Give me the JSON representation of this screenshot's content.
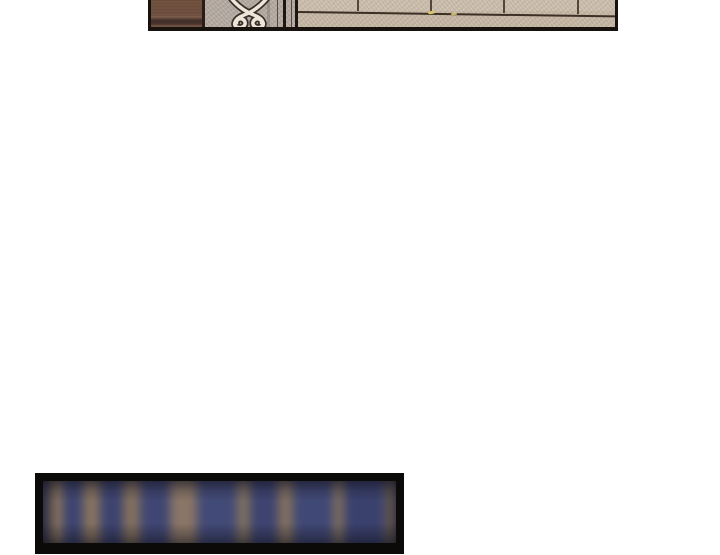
{
  "page": {
    "background_color": "#ffffff",
    "description": "vertical-scroll comic reader page with two image panels and no text"
  },
  "top_panel": {
    "description": "cropped comic panel: wooden post, stone gate pillar with iron scroll ornament, iron bars, stone wall in slight perspective",
    "border_color": "#17120e",
    "wood_post_color": "#6f5041",
    "wood_band_color": "#47332b",
    "pillar_color": "#b4aaa2",
    "ornament": {
      "fill": "#ece5d8",
      "outline": "#39302a"
    },
    "gate_bars": [
      {
        "x": 126,
        "type": "thin"
      },
      {
        "x": 132,
        "type": "thick"
      },
      {
        "x": 140,
        "type": "thin"
      },
      {
        "x": 144,
        "type": "thick"
      }
    ],
    "wall_color": "#c7b9a7",
    "mortar_color": "#3b2f26",
    "joints": [
      {
        "x": 206,
        "h": 11
      },
      {
        "x": 279,
        "h": 12
      },
      {
        "x": 352,
        "h": 13
      },
      {
        "x": 426,
        "h": 14
      }
    ],
    "specks": [
      {
        "x": 277,
        "y": 11,
        "w": 7,
        "h": 3,
        "color": "#d9c46a",
        "rot": -8
      },
      {
        "x": 300,
        "y": 13,
        "w": 6,
        "h": 2,
        "color": "#cdb964",
        "rot": -5
      }
    ]
  },
  "bottom_panel": {
    "description": "blurred photo-like panel of brown fence posts against dark blue dusk background in a black frame",
    "frame_color": "#0b0a09",
    "base_color": "#3e4572",
    "blur_px": 5,
    "segments": [
      {
        "w": 5,
        "c": "#39406b"
      },
      {
        "w": 15,
        "c": "#84705e"
      },
      {
        "w": 20,
        "c": "#3d4470"
      },
      {
        "w": 17,
        "c": "#87735f"
      },
      {
        "w": 23,
        "c": "#3c436f"
      },
      {
        "w": 17,
        "c": "#83705e"
      },
      {
        "w": 30,
        "c": "#3f4673"
      },
      {
        "w": 27,
        "c": "#8a7666"
      },
      {
        "w": 40,
        "c": "#424a77"
      },
      {
        "w": 13,
        "c": "#80705f"
      },
      {
        "w": 28,
        "c": "#3d4470"
      },
      {
        "w": 15,
        "c": "#83705e"
      },
      {
        "w": 40,
        "c": "#404875"
      },
      {
        "w": 11,
        "c": "#7f6e5d"
      },
      {
        "w": 42,
        "c": "#3a416d"
      },
      {
        "w": 10,
        "c": "#84705e"
      }
    ]
  }
}
